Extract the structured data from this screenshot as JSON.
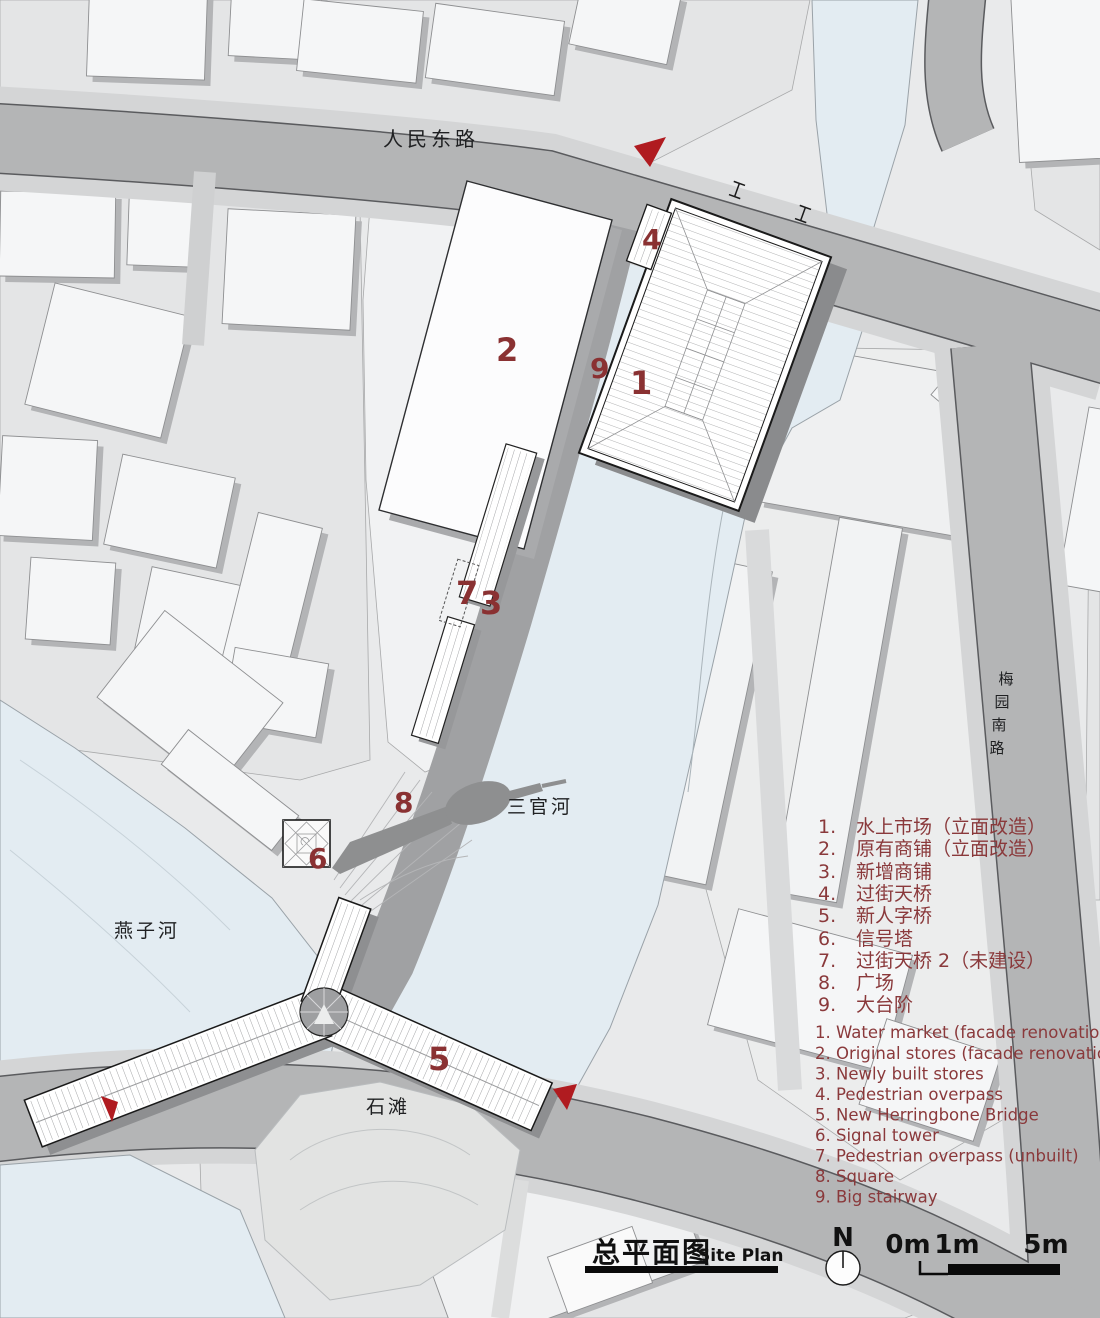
{
  "map": {
    "roads": {
      "renmin_east_road": "人民东路",
      "meiyuan_chars": [
        "梅",
        "园",
        "南",
        "路"
      ],
      "sanguan_river": "三官河",
      "yanzi_river": "燕子河",
      "shitan": "石滩"
    },
    "plan_markers": {
      "m1": "1",
      "m2": "2",
      "m3": "3",
      "m4": "4",
      "m5": "5",
      "m6": "6",
      "m7": "7",
      "m8": "8",
      "m9": "9"
    }
  },
  "legend_zh": {
    "items": [
      {
        "num": "1.",
        "label": "水上市场（立面改造）"
      },
      {
        "num": "2.",
        "label": "原有商铺（立面改造）"
      },
      {
        "num": "3.",
        "label": "新增商铺"
      },
      {
        "num": "4.",
        "label": "过街天桥"
      },
      {
        "num": "5.",
        "label": "新人字桥"
      },
      {
        "num": "6.",
        "label": "信号塔"
      },
      {
        "num": "7.",
        "label": "过街天桥 2（未建设）"
      },
      {
        "num": "8.",
        "label": "广场"
      },
      {
        "num": "9.",
        "label": "大台阶"
      }
    ]
  },
  "legend_en": {
    "items": [
      "1. Water market (facade renovation)",
      "2. Original stores (facade renovation)",
      "3. Newly built stores",
      "4. Pedestrian overpass",
      "5. New Herringbone Bridge",
      "6. Signal tower",
      "7. Pedestrian overpass (unbuilt)",
      "8. Square",
      "9. Big stairway"
    ]
  },
  "title": {
    "zh": "总平面图",
    "en": "Site Plan"
  },
  "compass": {
    "north_label": "N"
  },
  "scale_bar": {
    "labels": [
      "0m",
      "1m",
      "5m"
    ]
  },
  "colors": {
    "legend_red": "#8a393b",
    "marker_red": "#8a3132",
    "arrow_red": "#b01b20",
    "water": "#e3ecf2",
    "road": "#b4b5b6",
    "promenade": "#a0a1a3"
  }
}
